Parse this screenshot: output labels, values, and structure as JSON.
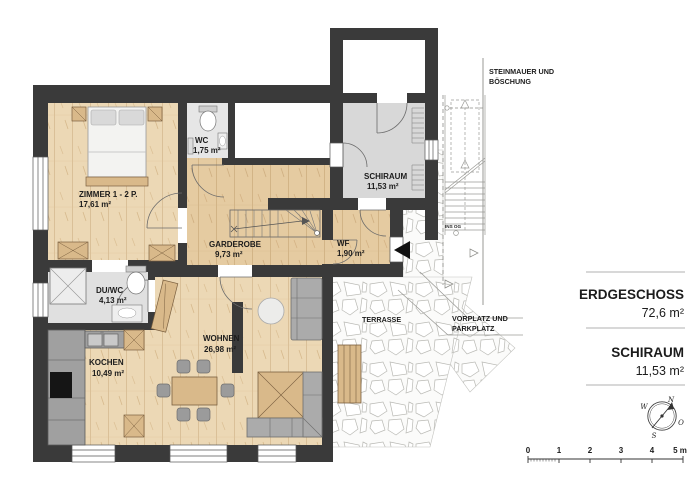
{
  "rooms": {
    "zimmer": {
      "name": "ZIMMER 1 - 2 P.",
      "area": "17,61 m²"
    },
    "wc": {
      "name": "WC",
      "area": "1,75 m²"
    },
    "schiraum": {
      "name": "SCHIRAUM",
      "area": "11,53 m²"
    },
    "garderobe": {
      "name": "GARDEROBE",
      "area": "9,73 m²"
    },
    "wf": {
      "name": "WF",
      "area": "1,90 m²"
    },
    "duwc": {
      "name": "DU/WC",
      "area": "4,13 m²"
    },
    "kochen": {
      "name": "KOCHEN",
      "area": "10,49 m²"
    },
    "wohnen": {
      "name": "WOHNEN",
      "area": "26,98 m²"
    },
    "terrasse": {
      "name": "TERRASSE"
    }
  },
  "site": {
    "steinmauer_line1": "STEINMAUER UND",
    "steinmauer_line2": "BÖSCHUNG",
    "vorplatz_line1": "VORPLATZ UND",
    "vorplatz_line2": "PARKPLATZ",
    "stairs_note": "INS OG"
  },
  "summary": {
    "floor_label": "ERDGESCHOSS",
    "floor_area": "72,6 m²",
    "annex_label": "SCHIRAUM",
    "annex_area": "11,53 m²"
  },
  "compass": {
    "north": "N",
    "east": "O",
    "south": "S",
    "west": "W"
  },
  "scale_bar": {
    "ticks": [
      "0",
      "1",
      "2",
      "3",
      "4"
    ],
    "end_label": "5 m"
  },
  "colors": {
    "wall": "#3a3a3a",
    "wood_floor": "#ecd8b5",
    "wood_floor_dark": "#e3c89e",
    "gray_floor": "#dcdcdc",
    "furniture_wood": "#d9b98a",
    "sofa_gray": "#ababab",
    "text": "#1c1c1c"
  }
}
